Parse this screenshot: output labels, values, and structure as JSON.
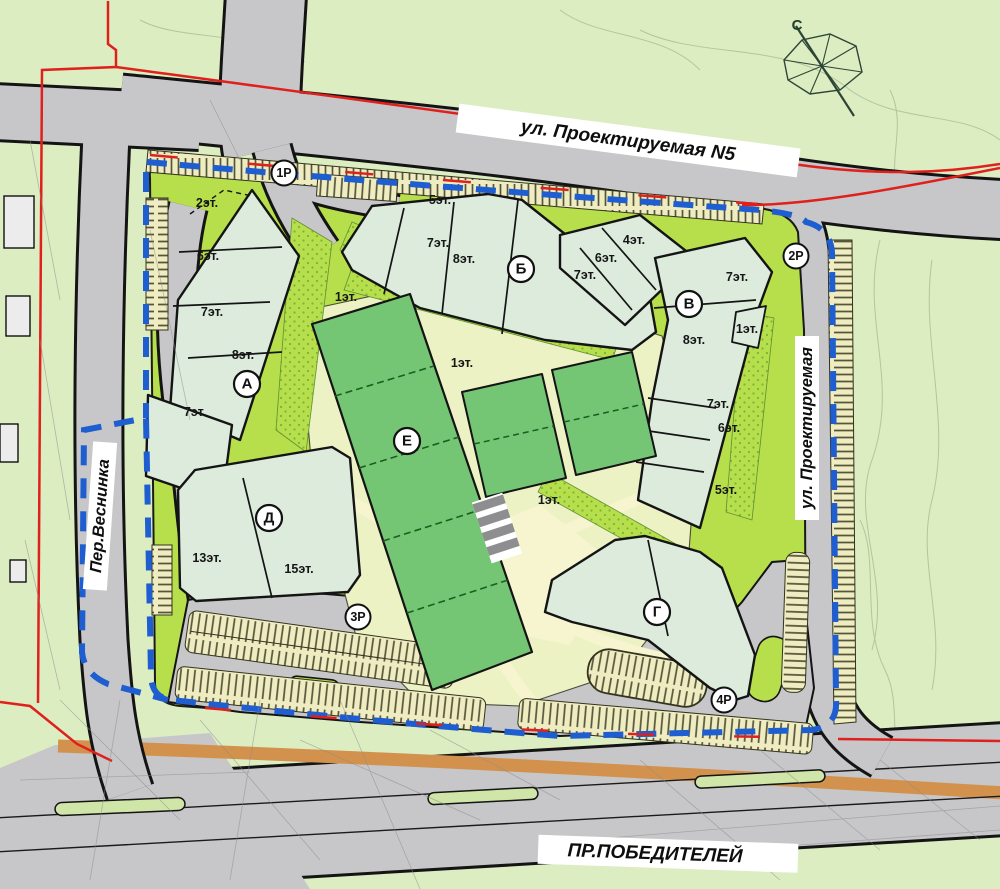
{
  "map": {
    "streets": {
      "top": "ул. Проектируемая N5",
      "left": "Пер.Веснинка",
      "right": "ул. Проектируемая",
      "bottom": "ПР.ПОБЕДИТЕЛЕЙ"
    },
    "compass": {
      "north": "С"
    },
    "buildings": {
      "a": {
        "letter": "А",
        "floors": [
          "2эт.",
          "6эт.",
          "7эт.",
          "8эт."
        ]
      },
      "a_west": {
        "floors": [
          "7эт."
        ]
      },
      "b": {
        "letter": "Б",
        "floors": [
          "5эт.",
          "7эт.",
          "8эт."
        ]
      },
      "b_wing": {
        "floors": [
          "4эт.",
          "6эт.",
          "7эт."
        ]
      },
      "v": {
        "letter": "В",
        "floors": [
          "7эт.",
          "1эт.",
          "8эт.",
          "7эт.",
          "6эт.",
          "5эт."
        ]
      },
      "g": {
        "letter": "Г"
      },
      "d": {
        "letter": "Д",
        "floors": [
          "13эт.",
          "15эт."
        ]
      },
      "e": {
        "letter": "Е",
        "floors": [
          "1эт.",
          "1эт.",
          "1эт."
        ]
      }
    },
    "parking": {
      "p1": "1Р",
      "p2": "2Р",
      "p3": "3Р",
      "p4": "4Р"
    },
    "colors": {
      "site_green": "#b7df4b",
      "outside_green": "#dcedc2",
      "building_fill": "#dcebdc",
      "school_green": "#74c674",
      "road_gray": "#c7c7c9",
      "path_cream": "#f4f2cc",
      "parking_cream": "#efecc1",
      "boundary_blue": "#1e5ed0",
      "boundary_red": "#e0201c",
      "railway_orange": "#d2924e"
    }
  }
}
